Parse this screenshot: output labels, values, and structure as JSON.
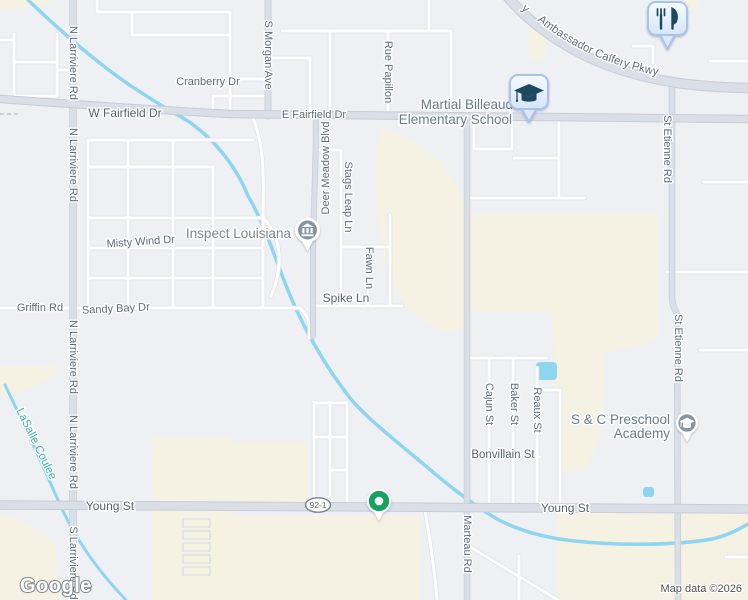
{
  "map": {
    "attribution": "Map data ©2026",
    "brand": "Google",
    "route_shield": "92-1"
  },
  "streets": {
    "cranberry": "Cranberry Dr",
    "w_fairfield": "W Fairfield Dr",
    "e_fairfield": "E Fairfield Dr",
    "s_morgan": "S Morgan Ave",
    "rue_papillon": "Rue Papillon",
    "n_larriviere": "N Larriviere Rd",
    "s_larriviere": "S Larriviere Rd",
    "deer_meadow": "Deer Meadow Blvd",
    "stags_leap": "Stags Leap Ln",
    "fawn": "Fawn Ln",
    "spike": "Spike Ln",
    "misty_wind": "Misty Wind Dr",
    "sandy_bay": "Sandy Bay Dr",
    "griffin": "Griffin Rd",
    "young": "Young St",
    "marteau": "Marteau Rd",
    "st_etienne": "St Etienne Rd",
    "cajun": "Cajun St",
    "baker": "Baker St",
    "reaux": "Reaux St",
    "bonvillain": "Bonvillain St",
    "ambassador": "Ambassador Caffery Pkwy",
    "ambassador_fragment": "y"
  },
  "water": {
    "lasalle": "LaSalle Coulee"
  },
  "pois": {
    "inspect": "Inspect Louisiana",
    "school_line1": "Martial Billeaud",
    "school_line2": "Elementary School",
    "preschool_line1": "S & C Preschool",
    "preschool_line2": "Academy"
  },
  "icons": {
    "restaurant_pin": "fork-knife",
    "school_pin": "graduation-cap",
    "inspect_pin": "institution-building",
    "preschool_pin": "graduation-cap-dot",
    "address_marker": "green-dot-marker"
  },
  "colors": {
    "land": "#eef0f3",
    "parkland": "#f5f1e3",
    "water": "#8ed5f0",
    "road_major": "#d9dee7",
    "road_minor": "#ffffff",
    "street_label": "#5d6b7a",
    "poi_label": "#7d858d",
    "school_label": "#687a8b",
    "water_label": "#3cb2a6",
    "pin_glyph": "#1d4a5f",
    "pin_fill_top": "#f6faff",
    "pin_fill_bottom": "#d7e5f8",
    "pin_border": "#a9c3e8",
    "poi_circle_gray": "#8794a2",
    "marker_green": "#16a35f"
  }
}
